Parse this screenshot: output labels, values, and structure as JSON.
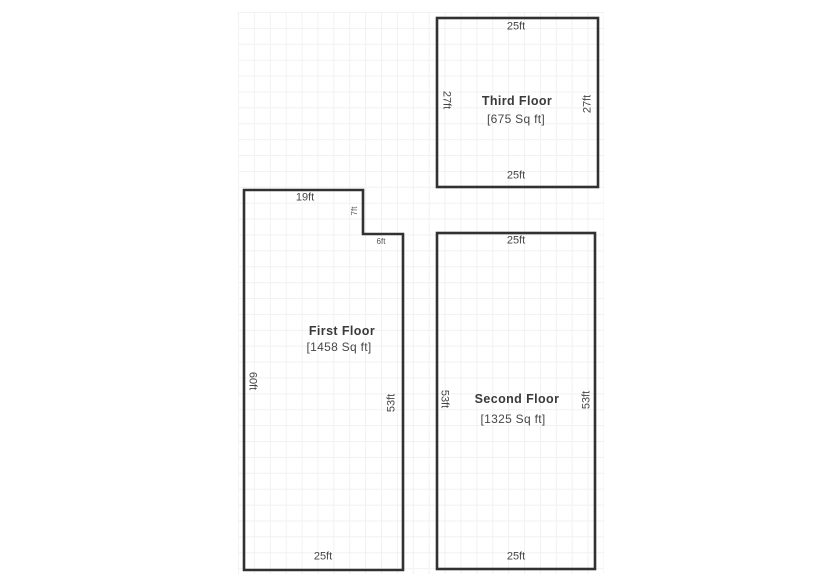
{
  "sketch": {
    "line_color": "#313131",
    "text_color": "#454545",
    "paper_grid_color": "#e7e7e2"
  },
  "floors": [
    {
      "id": "first",
      "name": "First Floor",
      "area": "[1458 Sq ft]",
      "dims": {
        "top": "19ft",
        "notch_height": "7ft",
        "notch_width": "6ft",
        "left": "60ft",
        "right": "53ft",
        "bottom": "25ft"
      }
    },
    {
      "id": "second",
      "name": "Second Floor",
      "area": "[1325 Sq ft]",
      "dims": {
        "top": "25ft",
        "left": "53ft",
        "right": "53ft",
        "bottom": "25ft"
      }
    },
    {
      "id": "third",
      "name": "Third Floor",
      "area": "[675 Sq ft]",
      "dims": {
        "top": "25ft",
        "left": "27ft",
        "right": "27ft",
        "bottom": "25ft"
      }
    }
  ]
}
